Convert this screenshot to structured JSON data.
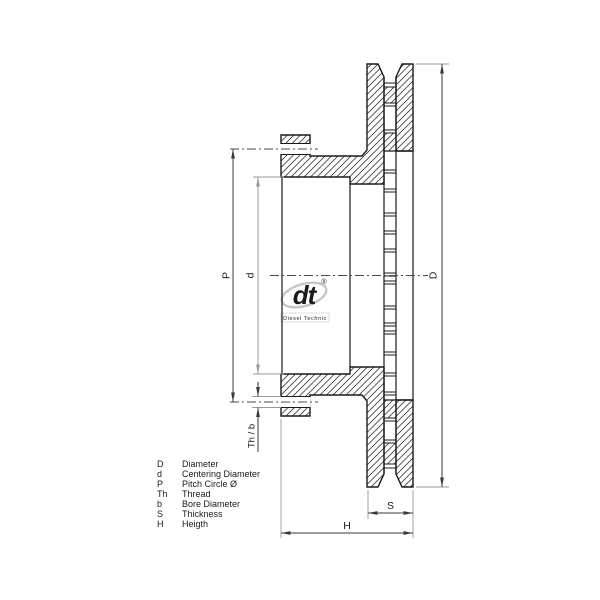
{
  "drawing_labels": {
    "D": "D",
    "d": "d",
    "P": "P",
    "Th_b": "Th / b",
    "S": "S",
    "H": "H"
  },
  "legend": [
    {
      "symbol": "D",
      "description": "Diameter"
    },
    {
      "symbol": "d",
      "description": "Centering Diameter"
    },
    {
      "symbol": "P",
      "description": "Pitch Circle Ø"
    },
    {
      "symbol": "Th",
      "description": "Thread"
    },
    {
      "symbol": "b",
      "description": "Bore Diameter"
    },
    {
      "symbol": "S",
      "description": "Thickness"
    },
    {
      "symbol": "H",
      "description": "Heigth"
    }
  ],
  "watermark": {
    "logo": "dt",
    "registered": "®",
    "subtext": "Diesel Technic"
  },
  "colors": {
    "outline": "#1a1a1a",
    "dimension_line": "#3a3a3a",
    "extension_line": "#9a9a9a",
    "gray_dimension": "#9a9a9a",
    "watermark": "#c6c6c6",
    "background": "#ffffff"
  }
}
